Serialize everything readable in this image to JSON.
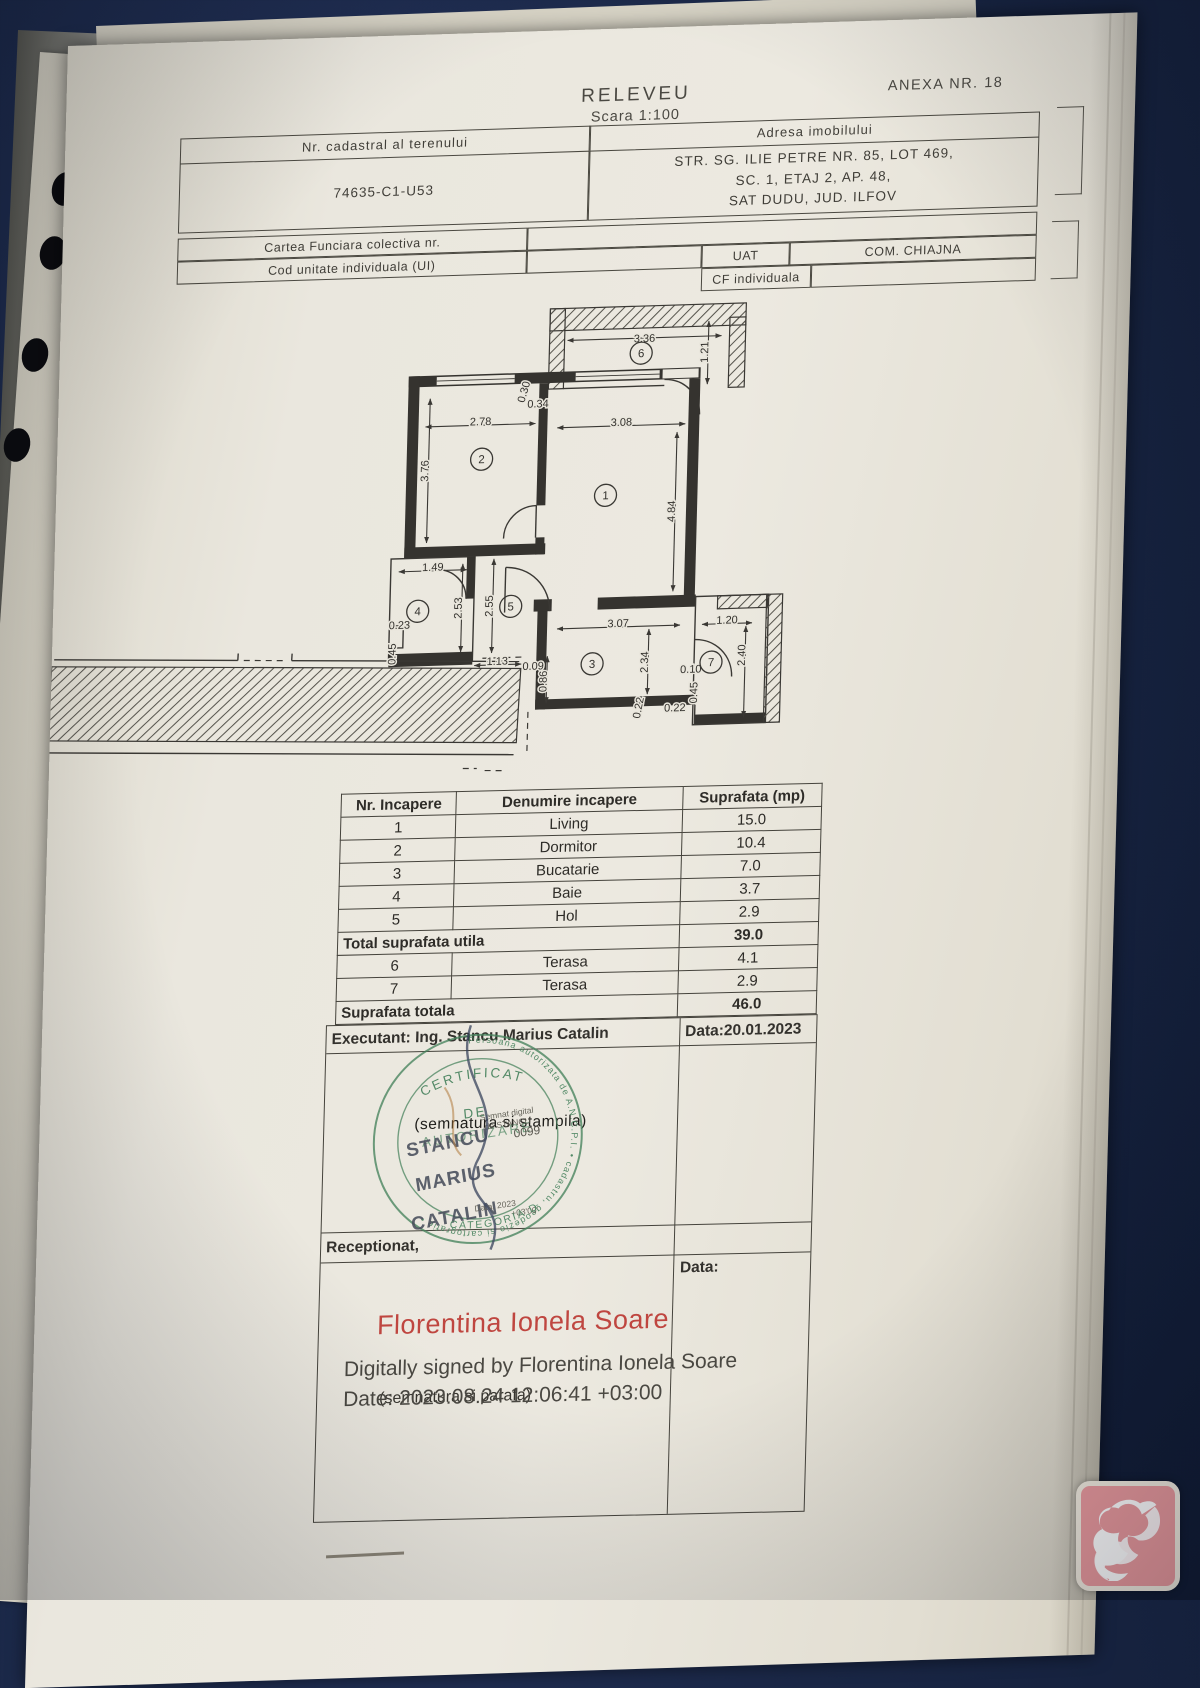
{
  "header": {
    "title": "RELEVEU",
    "scale": "Scara 1:100",
    "annex": "ANEXA NR. 18"
  },
  "top_table": {
    "left_header": "Nr. cadastral al terenului",
    "left_value": "74635-C1-U53",
    "right_header": "Adresa imobilului",
    "address_lines": [
      "STR. SG. ILIE PETRE NR. 85, LOT 469,",
      "SC. 1, ETAJ 2, AP. 48,",
      "SAT DUDU, JUD. ILFOV"
    ],
    "cf_label": "Cartea Funciara colectiva nr.",
    "ui_label": "Cod unitate individuala (UI)",
    "uat_label": "UAT",
    "uat_value": "COM. CHIAJNA",
    "cfi_label": "CF individuala",
    "cfi_value": ""
  },
  "floor_plan": {
    "rooms": [
      {
        "n": "1",
        "x": 550,
        "y": 198
      },
      {
        "n": "2",
        "x": 425,
        "y": 158
      },
      {
        "n": "3",
        "x": 541,
        "y": 366
      },
      {
        "n": "4",
        "x": 365,
        "y": 308
      },
      {
        "n": "5",
        "x": 458,
        "y": 306
      },
      {
        "n": "6",
        "x": 582,
        "y": 57
      },
      {
        "n": "7",
        "x": 660,
        "y": 368
      }
    ],
    "dimensions": [
      {
        "v": "3.36",
        "x": 585,
        "y": 46,
        "r": 0
      },
      {
        "v": "1.21",
        "x": 649,
        "y": 58,
        "r": -90
      },
      {
        "v": "0.30",
        "x": 469,
        "y": 93,
        "r": -75
      },
      {
        "v": "0.34",
        "x": 480,
        "y": 108,
        "r": 0
      },
      {
        "v": "2.78",
        "x": 423,
        "y": 124,
        "r": 0
      },
      {
        "v": "3.08",
        "x": 564,
        "y": 129,
        "r": 0
      },
      {
        "v": "3.76",
        "x": 372,
        "y": 168,
        "r": -90
      },
      {
        "v": "4.84",
        "x": 620,
        "y": 216,
        "r": -90
      },
      {
        "v": "1.49",
        "x": 379,
        "y": 268,
        "r": 0
      },
      {
        "v": "2.53",
        "x": 409,
        "y": 306,
        "r": -90
      },
      {
        "v": "2.55",
        "x": 440,
        "y": 305,
        "r": -90
      },
      {
        "v": "0.23",
        "x": 347,
        "y": 325,
        "r": 0
      },
      {
        "v": "0.45",
        "x": 344,
        "y": 350,
        "r": -90
      },
      {
        "v": "1.13",
        "x": 446,
        "y": 364,
        "r": 0
      },
      {
        "v": "0.09",
        "x": 482,
        "y": 370,
        "r": 0
      },
      {
        "v": "0.86",
        "x": 496,
        "y": 382,
        "r": -90
      },
      {
        "v": "3.07",
        "x": 566,
        "y": 330,
        "r": 0
      },
      {
        "v": "2.34",
        "x": 597,
        "y": 366,
        "r": -90
      },
      {
        "v": "0.22",
        "x": 592,
        "y": 412,
        "r": -80
      },
      {
        "v": "0.22",
        "x": 625,
        "y": 416,
        "r": 0
      },
      {
        "v": "0.10",
        "x": 640,
        "y": 378,
        "r": 0
      },
      {
        "v": "0.45",
        "x": 647,
        "y": 398,
        "r": -90
      },
      {
        "v": "1.20",
        "x": 675,
        "y": 330,
        "r": 0
      },
      {
        "v": "2.40",
        "x": 694,
        "y": 362,
        "r": -90
      }
    ]
  },
  "room_table": {
    "headers": [
      "Nr. Incapere",
      "Denumire incapere",
      "Suprafata (mp)"
    ],
    "rows": [
      {
        "n": "1",
        "name": "Living",
        "area": "15.0"
      },
      {
        "n": "2",
        "name": "Dormitor",
        "area": "10.4"
      },
      {
        "n": "3",
        "name": "Bucatarie",
        "area": "7.0"
      },
      {
        "n": "4",
        "name": "Baie",
        "area": "3.7"
      },
      {
        "n": "5",
        "name": "Hol",
        "area": "2.9"
      },
      {
        "merged": true,
        "label": "Total suprafata utila",
        "area": "39.0"
      },
      {
        "n": "6",
        "name": "Terasa",
        "area": "4.1"
      },
      {
        "n": "7",
        "name": "Terasa",
        "area": "2.9"
      },
      {
        "merged": true,
        "label": "Suprafata totala",
        "area": "46.0"
      }
    ]
  },
  "signature_block": {
    "executant_label": "Executant: Ing. Stancu Marius Catalin",
    "executant_date": "Data:20.01.2023",
    "stamp_note": "(semnatura si stampila)",
    "receptionat_label": "Receptionat,",
    "data_label": "Data:",
    "signer_name": "Florentina Ionela Soare",
    "digital_line1": "Digitally signed by Florentina Ionela Soare",
    "digital_line2": "Date: 2023.08.24 12:06:41 +03:00",
    "paraf_note": "(semnatura si parafa)"
  },
  "stamp": {
    "ring_text": "Persoana autorizata de A.N.C.P.I. • cadastru, geodezie si cartografie •",
    "cert1": "CERTIFICAT",
    "cert2": "DE",
    "cert3": "AUTORIZARE",
    "serial": "0099",
    "name_lines": [
      "STANCU",
      "MARIUS",
      "CATALIN"
    ],
    "digital_bits": [
      "Semnat digital",
      "de STANCU",
      "Data: 2023",
      "+03'00'"
    ],
    "category": "CATEGORIA D"
  },
  "colors": {
    "background_navy": "#16223f",
    "paper": "#eae7de",
    "stamp_green": "#47825d",
    "signer_red": "#bf4640",
    "logo_pink": "#ea9a9e"
  }
}
